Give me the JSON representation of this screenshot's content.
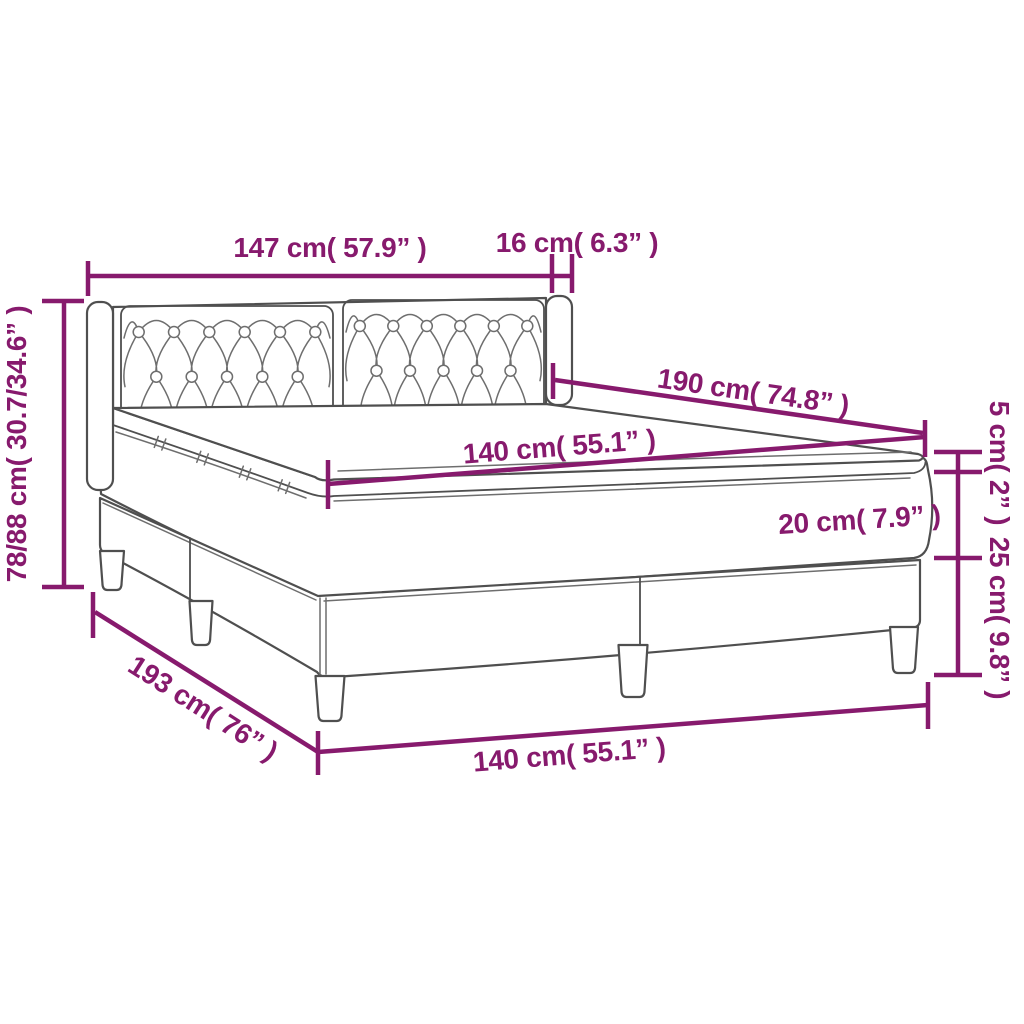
{
  "diagram": {
    "type": "product-dimension-diagram",
    "product": "box spring bed with tufted headboard and topper",
    "colors": {
      "dimension": "#871a6d",
      "outline": "#4f4f4f",
      "background": "#ffffff"
    },
    "labels": {
      "headboard_width": "147 cm( 57.9” )",
      "wing_depth": "16 cm( 6.3” )",
      "total_height": "78/88 cm( 30.7/34.6” )",
      "mattress_length": "190 cm( 74.8” )",
      "mattress_width_top": "140 cm( 55.1” )",
      "mattress_thickness": "20 cm( 7.9” )",
      "topper_thickness": "5 cm( 2” )",
      "base_height": "25 cm( 9.8” )",
      "frame_length": "193 cm( 76” )",
      "frame_width_bottom": "140 cm( 55.1” )"
    }
  }
}
